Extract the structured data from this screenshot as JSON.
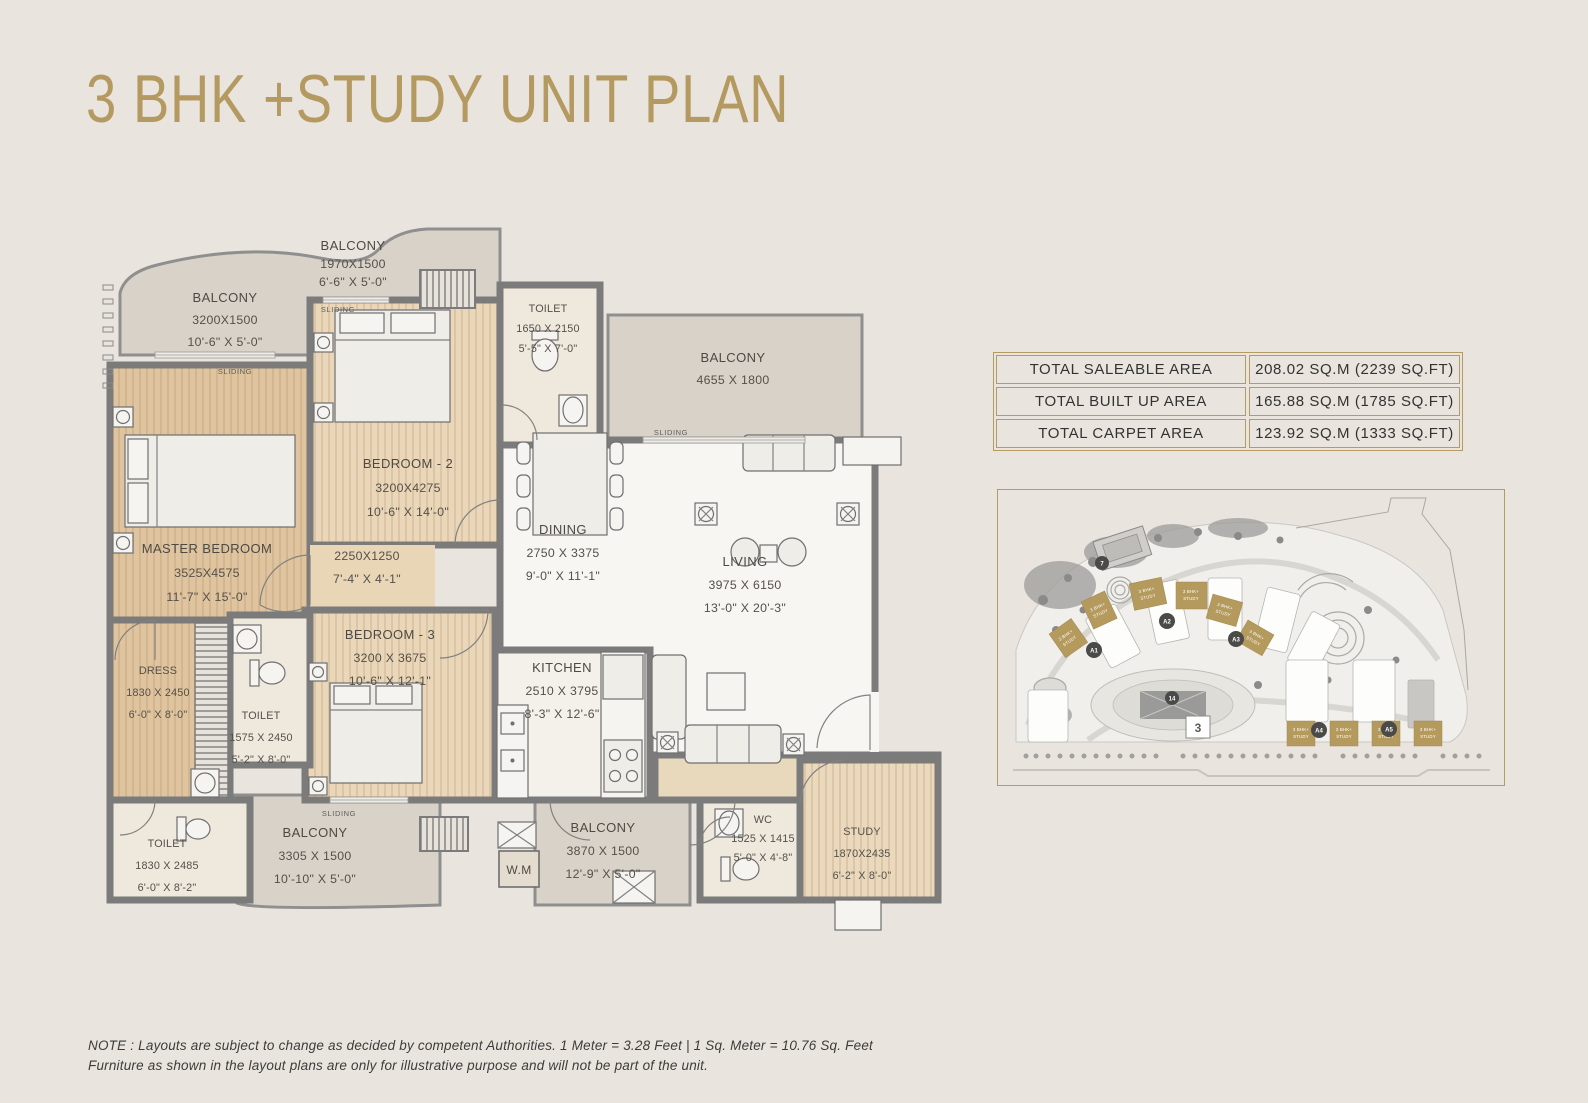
{
  "page": {
    "title": "3 BHK +STUDY UNIT PLAN",
    "note_line1": "NOTE : Layouts are subject to change as decided by competent Authorities. 1 Meter = 3.28 Feet | 1 Sq. Meter = 10.76 Sq. Feet",
    "note_line2": "Furniture as shown in the layout plans are only for illustrative purpose and will not be part of the unit."
  },
  "area_table": {
    "rows": [
      {
        "label": "TOTAL SALEABLE AREA",
        "value": "208.02 SQ.M (2239 SQ.FT)"
      },
      {
        "label": "TOTAL BUILT UP AREA",
        "value": "165.88 SQ.M (1785 SQ.FT)"
      },
      {
        "label": "TOTAL CARPET AREA",
        "value": "123.92 SQ.M (1333 SQ.FT)"
      }
    ]
  },
  "floor_plan": {
    "sliding_label": "SLIDING",
    "wm_label": "W.M",
    "rooms": {
      "balcony_tl": {
        "name": "BALCONY",
        "mm": "3200X1500",
        "ft": "10'-6\" X 5'-0\""
      },
      "balcony_top": {
        "name": "BALCONY",
        "mm": "1970X1500",
        "ft": "6'-6\" X 5'-0\""
      },
      "toilet_top": {
        "name": "TOILET",
        "mm": "1650 X 2150",
        "ft": "5'-5\" X 7'-0\""
      },
      "balcony_right": {
        "name": "BALCONY",
        "mm": "4655 X 1800",
        "ft": ""
      },
      "bedroom2": {
        "name": "BEDROOM - 2",
        "mm": "3200X4275",
        "ft": "10'-6\" X 14'-0\""
      },
      "master": {
        "name": "MASTER BEDROOM",
        "mm": "3525X4575",
        "ft": "11'-7\" X 15'-0\""
      },
      "passage": {
        "name": "",
        "mm": "2250X1250",
        "ft": "7'-4\" X 4'-1\""
      },
      "dining": {
        "name": "DINING",
        "mm": "2750 X 3375",
        "ft": "9'-0\" X 11'-1\""
      },
      "living": {
        "name": "LIVING",
        "mm": "3975 X 6150",
        "ft": "13'-0\" X 20'-3\""
      },
      "bedroom3": {
        "name": "BEDROOM - 3",
        "mm": "3200 X 3675",
        "ft": "10'-6\" X 12'-1\""
      },
      "dress": {
        "name": "DRESS",
        "mm": "1830 X 2450",
        "ft": "6'-0\" X 8'-0\""
      },
      "toilet_mid": {
        "name": "TOILET",
        "mm": "1575 X 2450",
        "ft": "5'-2\" X 8'-0\""
      },
      "kitchen": {
        "name": "KITCHEN",
        "mm": "2510 X 3795",
        "ft": "8'-3\" X 12'-6\""
      },
      "toilet_bl": {
        "name": "TOILET",
        "mm": "1830 X 2485",
        "ft": "6'-0\" X 8'-2\""
      },
      "balcony_bl": {
        "name": "BALCONY",
        "mm": "3305 X 1500",
        "ft": "10'-10\" X 5'-0\""
      },
      "balcony_bot": {
        "name": "BALCONY",
        "mm": "3870 X 1500",
        "ft": "12'-9\" X 5'-0\""
      },
      "wc": {
        "name": "WC",
        "mm": "1525 X 1415",
        "ft": "5'-0\" X 4'-8\""
      },
      "study": {
        "name": "STUDY",
        "mm": "1870X2435",
        "ft": "6'-2\" X 8'-0\""
      }
    }
  },
  "site_plan": {
    "block_line1": "3 BHK+",
    "block_line2": "STUDY",
    "badges": {
      "a1": "A1",
      "a2": "A2",
      "a3": "A3",
      "a4": "A4",
      "a5": "A5",
      "n7": "7",
      "n3": "3",
      "n14": "14"
    }
  }
}
